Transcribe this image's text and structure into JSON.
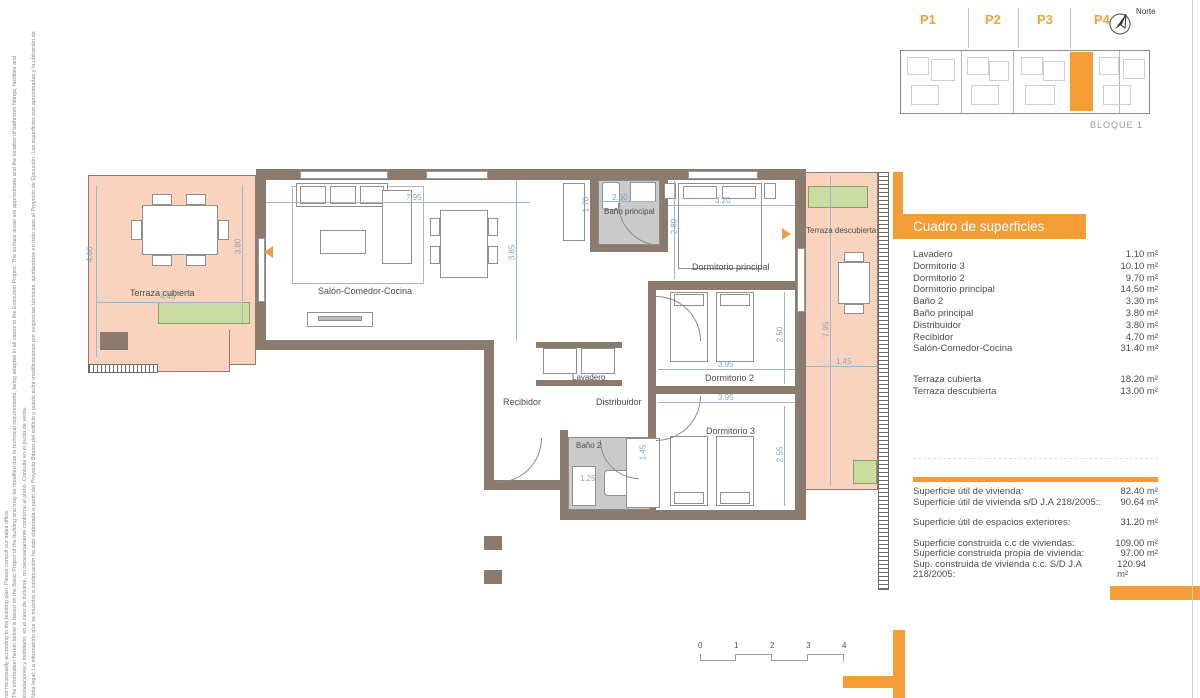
{
  "disclaimer": {
    "lines": [
      "Nota legal: La información que se muestra a continuación ha sido elaborada a partir del Proyecto Básico del edificio y puede sufrir modificaciones por exigencias técnicas, ajustándose en todo caso al Proyecto de Ejecución. Las superficies son aproximadas y la ubicación de",
      "instalaciones y mobiliario, en el caso de incluirse, no necesariamente conforme al plano. Consulte en el punto de venta.",
      "The information herein below is based on the Basic Project of the building and may be modified due to technical requirements, being adapted in all cases to the Execution Project. The surface areas are approximate and the location of bathroom fittings, facilities and",
      "not necessarily according to the building plan. Please consult our sales office."
    ]
  },
  "keyplan": {
    "units": [
      {
        "label": "P1"
      },
      {
        "label": "P2"
      },
      {
        "label": "P3"
      },
      {
        "label": "P4"
      }
    ],
    "north_label": "Norte",
    "block_label": "BLOQUE 1",
    "highlight_color": "#F49C36"
  },
  "surfaces": {
    "title": "Cuadro de superficies",
    "rows": [
      {
        "name": "Lavadero",
        "value": "1.10 m²"
      },
      {
        "name": "Dormitorio 3",
        "value": "10.10 m²"
      },
      {
        "name": "Dormitorio 2",
        "value": "9.70 m²"
      },
      {
        "name": "Dormitorio principal",
        "value": "14.50 m²"
      },
      {
        "name": "Baño 2",
        "value": "3.30 m²"
      },
      {
        "name": "Baño principal",
        "value": "3.80 m²"
      },
      {
        "name": "Distribuidor",
        "value": "3.80 m²"
      },
      {
        "name": "Recibidor",
        "value": "4.70 m²"
      },
      {
        "name": "Salón-Comedor-Cocina",
        "value": "31.40 m²"
      }
    ],
    "terrace_rows": [
      {
        "name": "Terraza cubierta",
        "value": "18.20 m²"
      },
      {
        "name": "Terraza descubierta",
        "value": "13.00 m²"
      }
    ],
    "totals": [
      {
        "name": "Superficie útil de vivienda:",
        "value": "82.40 m²"
      },
      {
        "name": "Superficie útil de vivienda s/D J.A 218/2005::",
        "value": "90.64 m²"
      },
      {
        "name": "Superficie útil de espacios exteriores:",
        "value": "31.20 m²"
      },
      {
        "name": "Superficie construida c.c de viviendas:",
        "value": "109.00 m²"
      },
      {
        "name": "Superficie construida propia de vivienda:",
        "value": "97.00 m²"
      },
      {
        "name": "Sup. construida de vivienda c.c. S/D J.A 218/2005:",
        "value": "120.94 m²"
      }
    ]
  },
  "plan": {
    "rooms": [
      {
        "label": "Terraza cubierta"
      },
      {
        "label": "Salón-Comedor-Cocina"
      },
      {
        "label": "Baño principal"
      },
      {
        "label": "Dormitorio principal"
      },
      {
        "label": "Terraza descubierta"
      },
      {
        "label": "Lavadero"
      },
      {
        "label": "Recibidor"
      },
      {
        "label": "Distribuidor"
      },
      {
        "label": "Dormitorio 2"
      },
      {
        "label": "Baño 2"
      },
      {
        "label": "Dormitorio 3"
      }
    ],
    "dims": {
      "tc_h1": "4.60",
      "tc_h2": "3.80",
      "tc_w": "4.45",
      "salon_w": "7.95",
      "salon_h": "3.85",
      "bp_w": "2.30",
      "closet_h": "1.70",
      "dp_w": "3.20",
      "dp_h": "2.80",
      "d2_w": "3.95",
      "d2_h": "2.50",
      "d3_w": "3.95",
      "d3_h": "2.55",
      "b2_w": "1.25",
      "ward_h": "1.45",
      "td_h": "7.95",
      "td_w": "1.45"
    },
    "accent_colors": {
      "terrace": "#F9D3BD",
      "planter": "#CBDCA2",
      "wall": "#8A7B6E",
      "dimension": "#85A3C4"
    }
  },
  "scalebar": {
    "ticks": [
      {
        "label": "0"
      },
      {
        "label": "1"
      },
      {
        "label": "2"
      },
      {
        "label": "3"
      },
      {
        "label": "4"
      }
    ]
  }
}
